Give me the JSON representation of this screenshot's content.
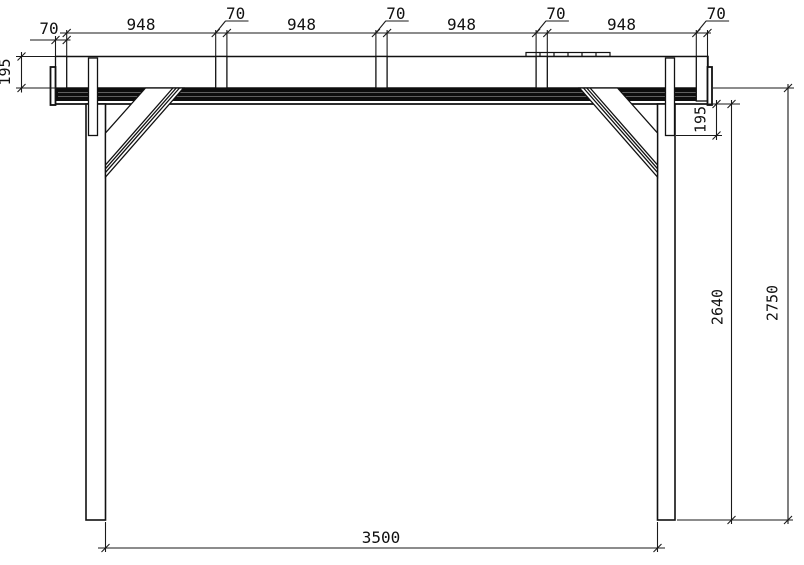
{
  "page": {
    "background": "#ffffff"
  },
  "drawing": {
    "kind": "technical elevation drawing",
    "colors": {
      "line": "#111111",
      "dark_fill": "#0d0d0d",
      "background": "#ffffff"
    },
    "dims": {
      "top_chain": [
        "70",
        "948",
        "70",
        "948",
        "70",
        "948",
        "70",
        "948",
        "70"
      ],
      "beam_height_left": "195",
      "tenon_length_right": "195",
      "clear_height": "2640",
      "overall_height": "2750",
      "post_span": "3500"
    }
  }
}
